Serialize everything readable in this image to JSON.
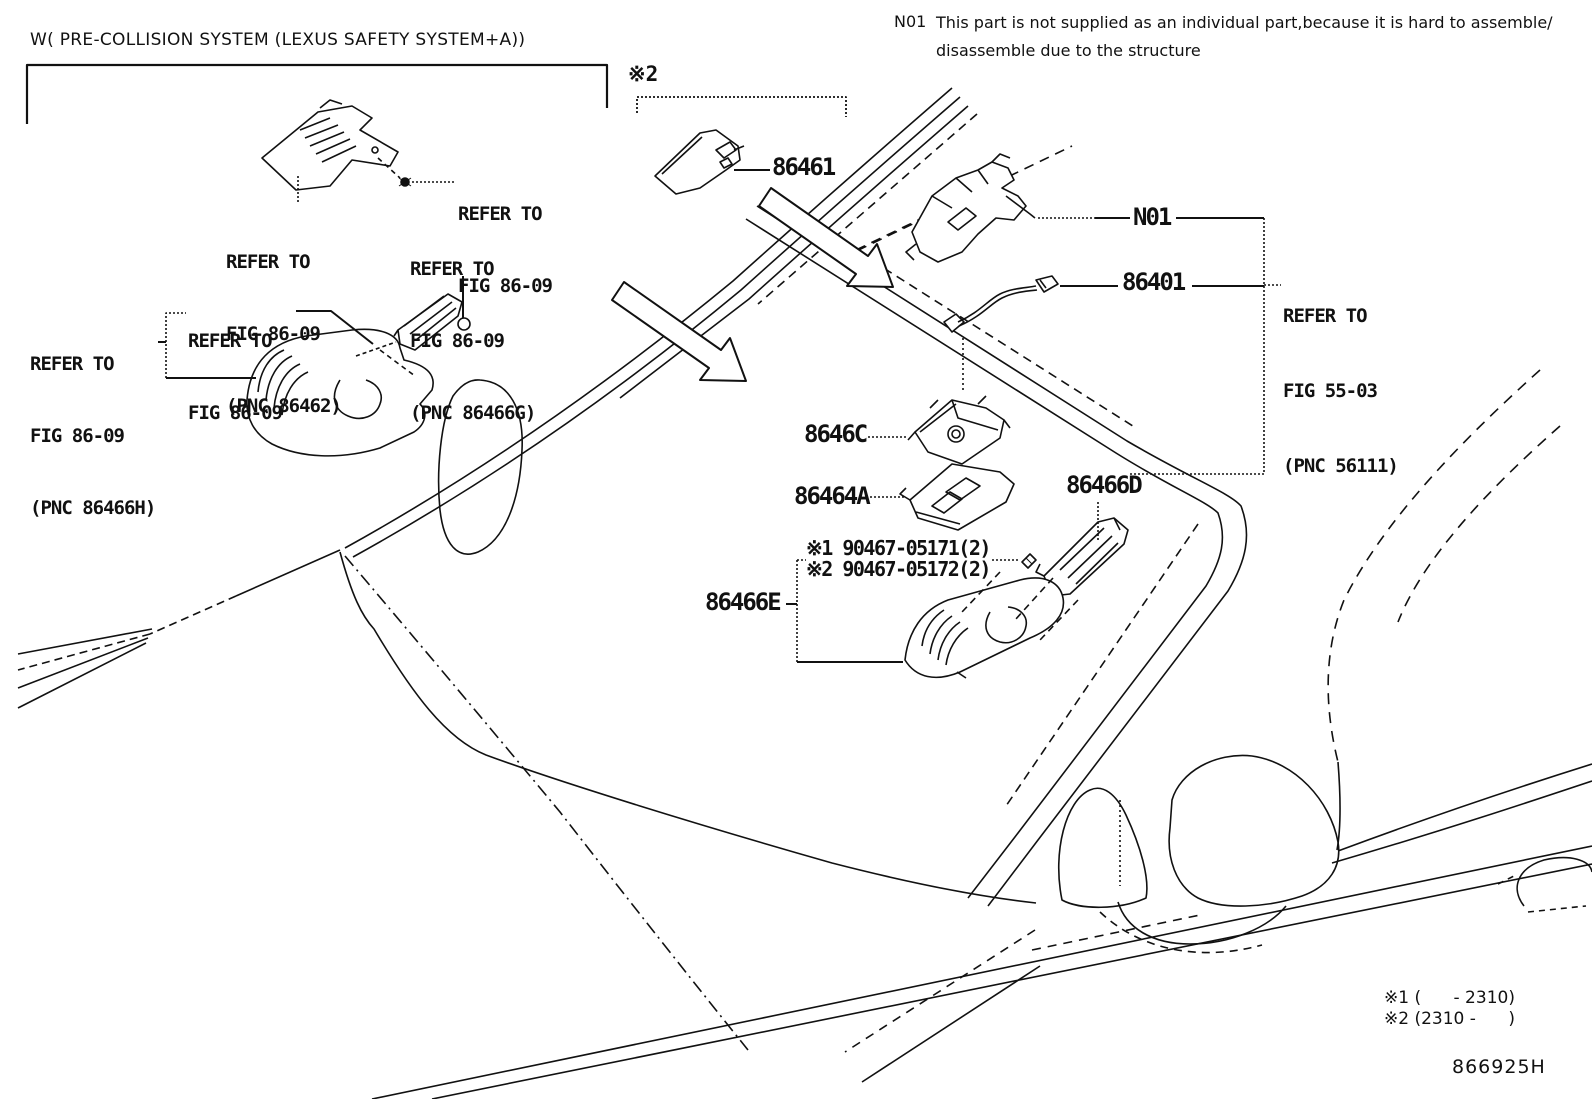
{
  "header": {
    "title": "W( PRE-COLLISION SYSTEM (LEXUS SAFETY SYSTEM+A))",
    "note_code": "N01",
    "note_line1": "This part is not supplied as an individual part,because it is hard to assemble/",
    "note_line2": "disassemble due to the structure"
  },
  "callouts": {
    "x2": "※2",
    "p86461": "86461",
    "n01": "N01",
    "p86401": "86401",
    "p8646c": "8646C",
    "p86464a": "86464A",
    "p86466d": "86466D",
    "p86466e": "86466E",
    "bolt1": "※1 90467-05171(2)",
    "bolt2": "※2 90467-05172(2)"
  },
  "refs": {
    "screw": [
      "REFER TO",
      "FIG 86-09"
    ],
    "pnc86462": [
      "REFER TO",
      "FIG 86-09",
      "(PNC 86462)"
    ],
    "pnc86466g": [
      "REFER TO",
      "FIG 86-09",
      "(PNC 86466G)"
    ],
    "mid": [
      "REFER TO",
      "FIG 86-09"
    ],
    "pnc86466h": [
      "REFER TO",
      "FIG 86-09",
      "(PNC 86466H)"
    ],
    "pnc56111": [
      "REFER TO",
      "FIG 55-03",
      "(PNC 56111)"
    ]
  },
  "footnotes": {
    "f1": "※1 (      - 2310)",
    "f2": "※2 (2310 -      )"
  },
  "drawing_number": "866925H",
  "colors": {
    "ink": "#111111",
    "paper": "#ffffff"
  }
}
